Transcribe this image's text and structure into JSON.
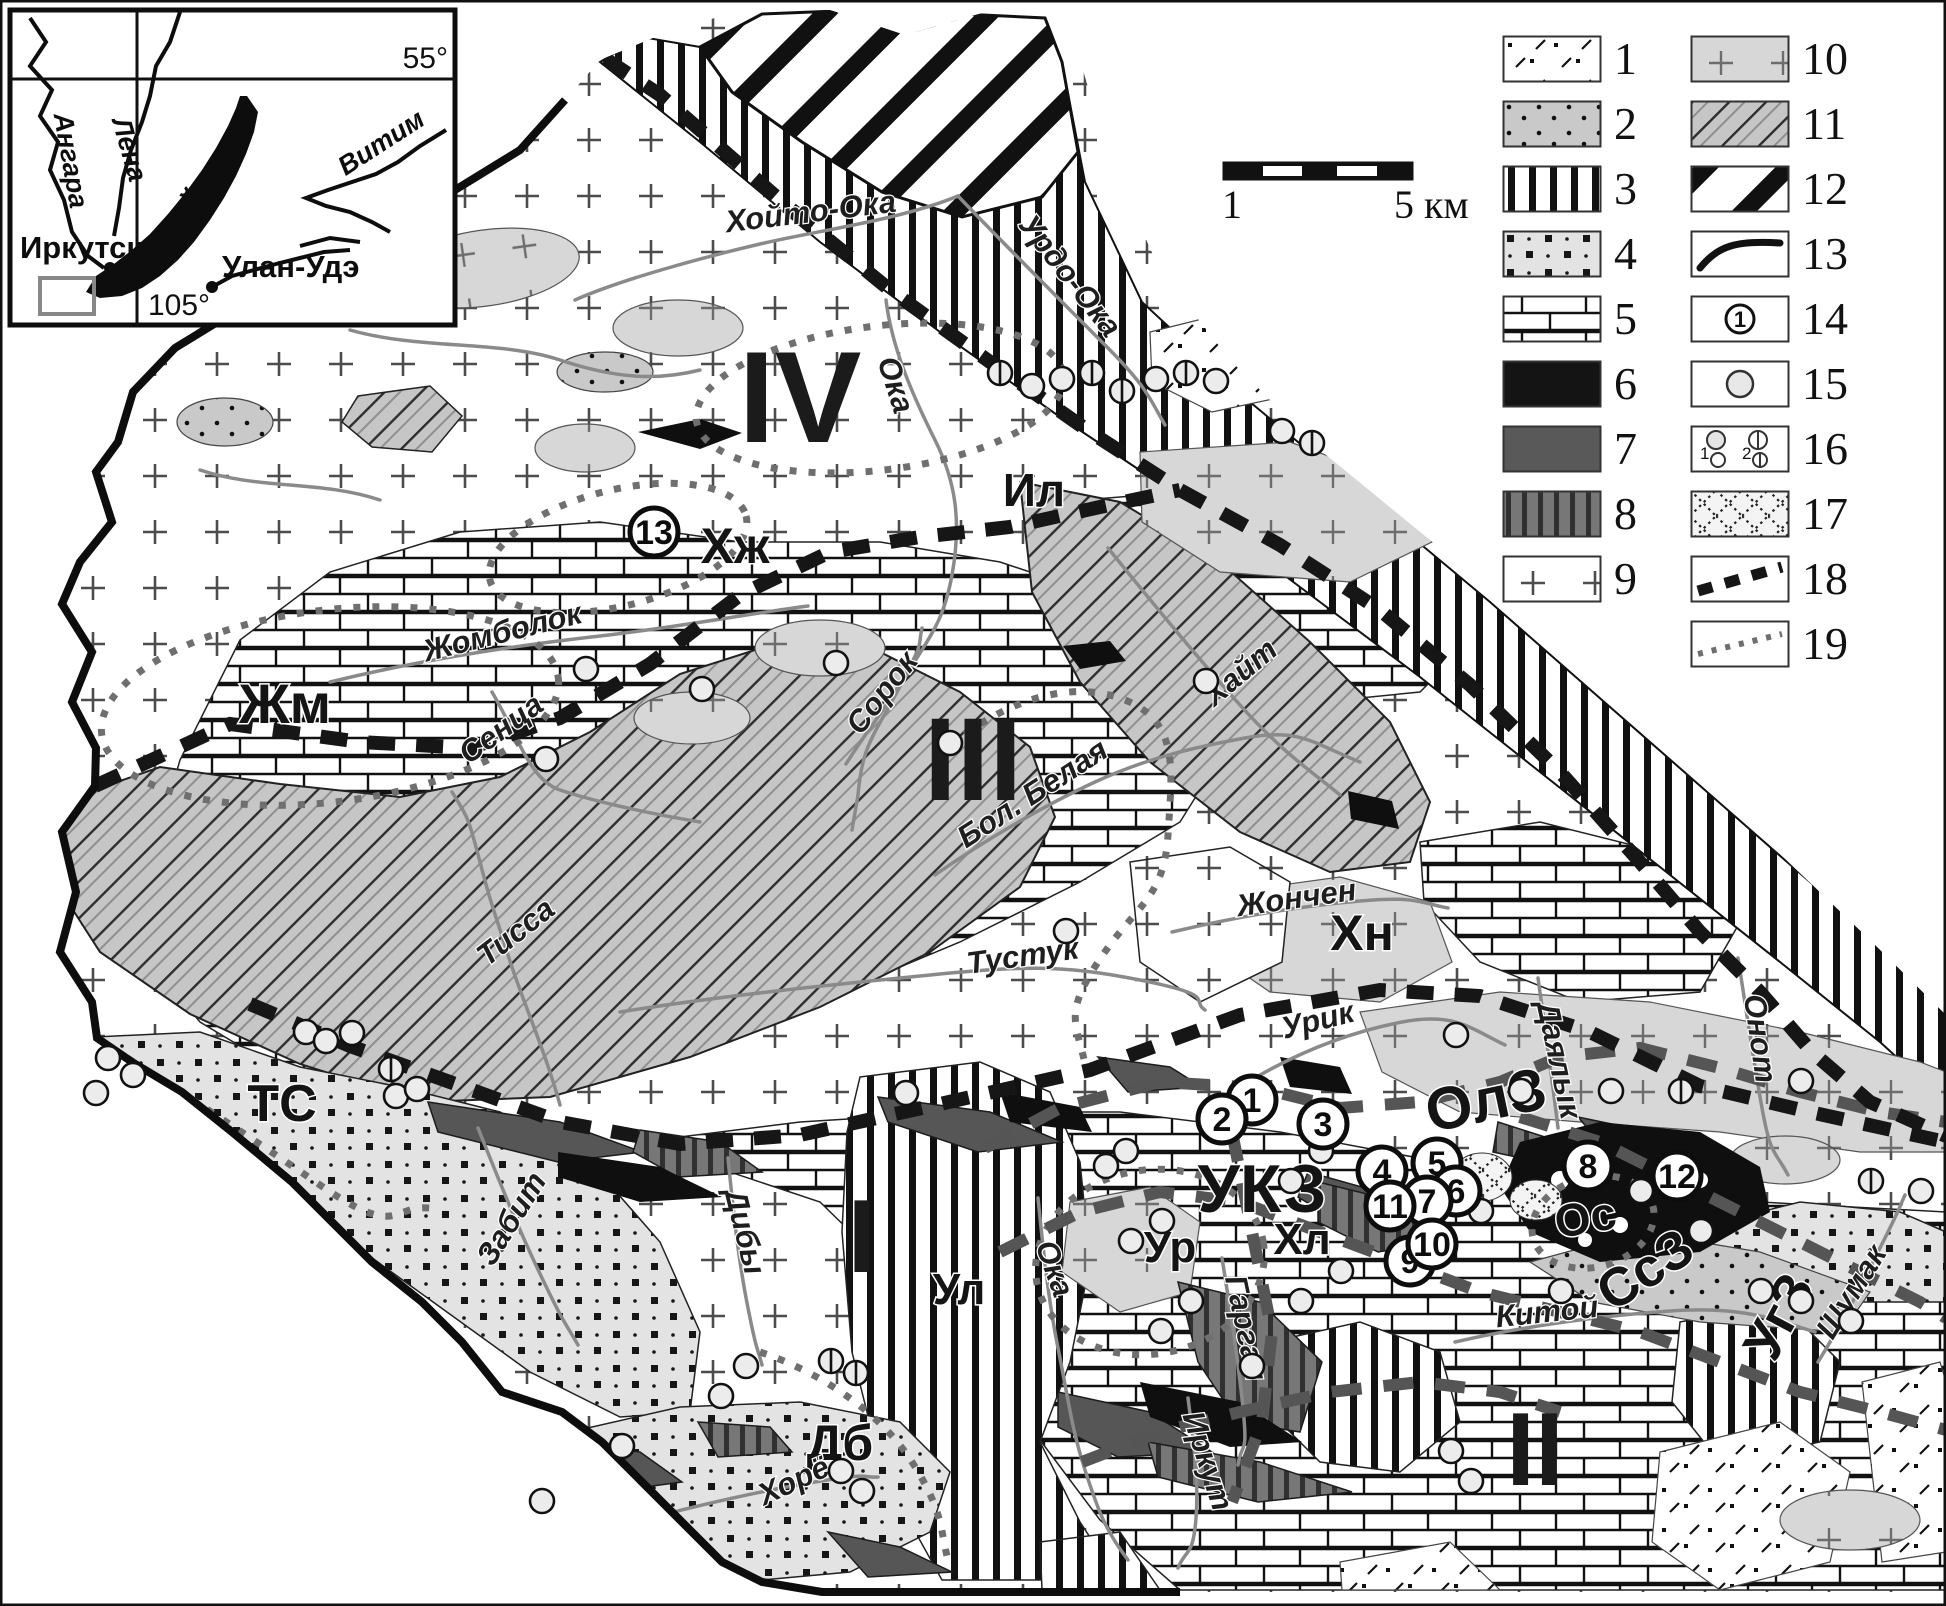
{
  "inset_map": {
    "grid_labels": {
      "lat": "55°",
      "lon": "105°"
    },
    "lake_label": "оз. Байкал",
    "cities": [
      {
        "name": "Иркутск",
        "x": 110,
        "y": 268,
        "label_x": 20,
        "label_y": 258
      },
      {
        "name": "Улан-Удэ",
        "x": 212,
        "y": 287,
        "label_x": 222,
        "label_y": 277
      }
    ],
    "river_labels": [
      {
        "name": "Ангара",
        "x": 62,
        "y": 162,
        "rotate": 80
      },
      {
        "name": "Лена",
        "x": 121,
        "y": 152,
        "rotate": 74
      },
      {
        "name": "Витим",
        "x": 386,
        "y": 150,
        "rotate": -33
      }
    ]
  },
  "scale_bar": {
    "left_label": "1",
    "right_label": "5 км"
  },
  "legend": {
    "items": [
      {
        "number": "1",
        "symbol": "dash-dot-pattern"
      },
      {
        "number": "2",
        "symbol": "gray-dots-pattern"
      },
      {
        "number": "3",
        "symbol": "vertical-bars-pattern"
      },
      {
        "number": "4",
        "symbol": "squares-dots-pattern"
      },
      {
        "number": "5",
        "symbol": "brick-pattern"
      },
      {
        "number": "6",
        "symbol": "solid-black"
      },
      {
        "number": "7",
        "symbol": "solid-dark-gray"
      },
      {
        "number": "8",
        "symbol": "dark-vertical-stripes"
      },
      {
        "number": "9",
        "symbol": "white-plus-pattern"
      },
      {
        "number": "10",
        "symbol": "gray-plus-pattern"
      },
      {
        "number": "11",
        "symbol": "diagonal-hatch-pattern"
      },
      {
        "number": "12",
        "symbol": "black-diagonal-stripes"
      },
      {
        "number": "13",
        "symbol": "thick-curved-line"
      },
      {
        "number": "14",
        "symbol": "circled-number"
      },
      {
        "number": "15",
        "symbol": "single-circle"
      },
      {
        "number": "16",
        "symbol": "two-circle-types"
      },
      {
        "number": "17",
        "symbol": "diamond-lattice-pattern"
      },
      {
        "number": "18",
        "symbol": "black-dashed-line"
      },
      {
        "number": "19",
        "symbol": "gray-dotted-line"
      }
    ]
  },
  "map": {
    "region_numerals": [
      {
        "text": "IV",
        "x": 800,
        "y": 442,
        "size": 130
      },
      {
        "text": "III",
        "x": 973,
        "y": 800,
        "size": 118
      },
      {
        "text": "I",
        "x": 862,
        "y": 1272,
        "size": 104
      },
      {
        "text": "II",
        "x": 1535,
        "y": 1485,
        "size": 104
      }
    ],
    "zone_labels": [
      {
        "text": "УКЗ",
        "x": 1262,
        "y": 1212,
        "size": 68,
        "rotate": 0
      },
      {
        "text": "ОлЗ",
        "x": 1490,
        "y": 1120,
        "size": 60,
        "rotate": -12
      },
      {
        "text": "СсЗ",
        "x": 1655,
        "y": 1285,
        "size": 54,
        "rotate": -33
      },
      {
        "text": "УгЗ",
        "x": 1795,
        "y": 1325,
        "size": 54,
        "rotate": -62
      },
      {
        "text": "Ос",
        "x": 1588,
        "y": 1233,
        "size": 46,
        "rotate": -10
      },
      {
        "text": "ТС",
        "x": 282,
        "y": 1121,
        "size": 52,
        "rotate": 0
      },
      {
        "text": "Жм",
        "x": 285,
        "y": 723,
        "size": 56,
        "rotate": 0
      },
      {
        "text": "Хн",
        "x": 1362,
        "y": 950,
        "size": 50,
        "rotate": 0
      },
      {
        "text": "Хж",
        "x": 735,
        "y": 563,
        "size": 50,
        "rotate": 0
      },
      {
        "text": "Ил",
        "x": 1034,
        "y": 506,
        "size": 46,
        "rotate": 0
      },
      {
        "text": "Дб",
        "x": 840,
        "y": 1460,
        "size": 50,
        "rotate": 0
      },
      {
        "text": "Ур",
        "x": 1170,
        "y": 1262,
        "size": 44,
        "rotate": 0
      },
      {
        "text": "Хл",
        "x": 1302,
        "y": 1254,
        "size": 44,
        "rotate": 0
      },
      {
        "text": "Ул",
        "x": 959,
        "y": 1304,
        "size": 44,
        "rotate": 0
      }
    ],
    "river_labels": [
      {
        "text": "Хойто-Ока",
        "x": 812,
        "y": 222,
        "rotate": -7
      },
      {
        "text": "Урдо-Ока",
        "x": 1062,
        "y": 282,
        "rotate": 52
      },
      {
        "text": "Ока",
        "x": 886,
        "y": 388,
        "rotate": 72
      },
      {
        "text": "Жомболок",
        "x": 505,
        "y": 642,
        "rotate": -14
      },
      {
        "text": "Сенца",
        "x": 507,
        "y": 737,
        "rotate": -36
      },
      {
        "text": "Сорок",
        "x": 890,
        "y": 699,
        "rotate": -52
      },
      {
        "text": "Бол. Белая",
        "x": 1038,
        "y": 802,
        "rotate": -33
      },
      {
        "text": "Тисса",
        "x": 522,
        "y": 940,
        "rotate": -38
      },
      {
        "text": "Тустук",
        "x": 1024,
        "y": 966,
        "rotate": -8
      },
      {
        "text": "Хайт",
        "x": 1247,
        "y": 680,
        "rotate": -40
      },
      {
        "text": "Жончен",
        "x": 1298,
        "y": 908,
        "rotate": -8
      },
      {
        "text": "Урик",
        "x": 1320,
        "y": 1030,
        "rotate": -14
      },
      {
        "text": "Даялык",
        "x": 1549,
        "y": 1062,
        "rotate": 78
      },
      {
        "text": "Онот",
        "x": 1750,
        "y": 1040,
        "rotate": 82
      },
      {
        "text": "Забит",
        "x": 520,
        "y": 1224,
        "rotate": -58
      },
      {
        "text": "Дибы",
        "x": 735,
        "y": 1234,
        "rotate": 76
      },
      {
        "text": "Ока",
        "x": 1045,
        "y": 1272,
        "rotate": 70
      },
      {
        "text": "Гарган",
        "x": 1236,
        "y": 1330,
        "rotate": 78
      },
      {
        "text": "Иркут",
        "x": 1198,
        "y": 1464,
        "rotate": 72
      },
      {
        "text": "Китой",
        "x": 1548,
        "y": 1322,
        "rotate": -6
      },
      {
        "text": "Шумак",
        "x": 1860,
        "y": 1297,
        "rotate": -58
      },
      {
        "text": "Хорё",
        "x": 798,
        "y": 1490,
        "rotate": -25
      }
    ],
    "numbered_points": [
      {
        "n": "1",
        "x": 1252,
        "y": 1100
      },
      {
        "n": "2",
        "x": 1222,
        "y": 1119
      },
      {
        "n": "3",
        "x": 1323,
        "y": 1124
      },
      {
        "n": "4",
        "x": 1382,
        "y": 1171
      },
      {
        "n": "5",
        "x": 1437,
        "y": 1163
      },
      {
        "n": "6",
        "x": 1456,
        "y": 1191
      },
      {
        "n": "7",
        "x": 1427,
        "y": 1201
      },
      {
        "n": "8",
        "x": 1588,
        "y": 1166
      },
      {
        "n": "9",
        "x": 1410,
        "y": 1261
      },
      {
        "n": "10",
        "x": 1432,
        "y": 1244
      },
      {
        "n": "11",
        "x": 1390,
        "y": 1206
      },
      {
        "n": "12",
        "x": 1677,
        "y": 1176
      },
      {
        "n": "13",
        "x": 654,
        "y": 532
      }
    ],
    "ore_points": [
      [
        1000,
        373,
        2
      ],
      [
        1032,
        386,
        1
      ],
      [
        1062,
        379,
        1
      ],
      [
        1092,
        373,
        2
      ],
      [
        1122,
        391,
        2
      ],
      [
        1156,
        379,
        1
      ],
      [
        1186,
        373,
        2
      ],
      [
        1216,
        381,
        1
      ],
      [
        1282,
        431,
        1
      ],
      [
        1312,
        443,
        2
      ],
      [
        586,
        669,
        1
      ],
      [
        702,
        689,
        1
      ],
      [
        836,
        663,
        1
      ],
      [
        546,
        759,
        1
      ],
      [
        950,
        743,
        1
      ],
      [
        906,
        1093,
        1
      ],
      [
        1066,
        931,
        1
      ],
      [
        1206,
        681,
        1
      ],
      [
        1456,
        1035,
        1
      ],
      [
        306,
        1032,
        1
      ],
      [
        326,
        1041,
        1
      ],
      [
        352,
        1033,
        1
      ],
      [
        391,
        1069,
        2
      ],
      [
        396,
        1096,
        1
      ],
      [
        417,
        1089,
        1
      ],
      [
        108,
        1058,
        1
      ],
      [
        133,
        1075,
        1
      ],
      [
        96,
        1093,
        1
      ],
      [
        831,
        1361,
        2
      ],
      [
        856,
        1373,
        2
      ],
      [
        746,
        1366,
        1
      ],
      [
        721,
        1396,
        1
      ],
      [
        841,
        1471,
        1
      ],
      [
        862,
        1491,
        1
      ],
      [
        622,
        1446,
        1
      ],
      [
        542,
        1501,
        1
      ],
      [
        1126,
        1151,
        1
      ],
      [
        1106,
        1166,
        1
      ],
      [
        1162,
        1221,
        1
      ],
      [
        1131,
        1241,
        1
      ],
      [
        1191,
        1301,
        1
      ],
      [
        1252,
        1366,
        1
      ],
      [
        1161,
        1331,
        1
      ],
      [
        1301,
        1301,
        1
      ],
      [
        1341,
        1271,
        1
      ],
      [
        1291,
        1181,
        1
      ],
      [
        1321,
        1151,
        1
      ],
      [
        1521,
        1091,
        1
      ],
      [
        1611,
        1091,
        1
      ],
      [
        1641,
        1191,
        1
      ],
      [
        1701,
        1231,
        1
      ],
      [
        1761,
        1291,
        1
      ],
      [
        1801,
        1301,
        1
      ],
      [
        1851,
        1321,
        1
      ],
      [
        1481,
        1211,
        1
      ],
      [
        1561,
        1291,
        1
      ],
      [
        1681,
        1091,
        2
      ],
      [
        1801,
        1081,
        1
      ],
      [
        1871,
        1181,
        2
      ],
      [
        1921,
        1191,
        1
      ],
      [
        1451,
        1451,
        1
      ],
      [
        1471,
        1481,
        1
      ]
    ]
  }
}
